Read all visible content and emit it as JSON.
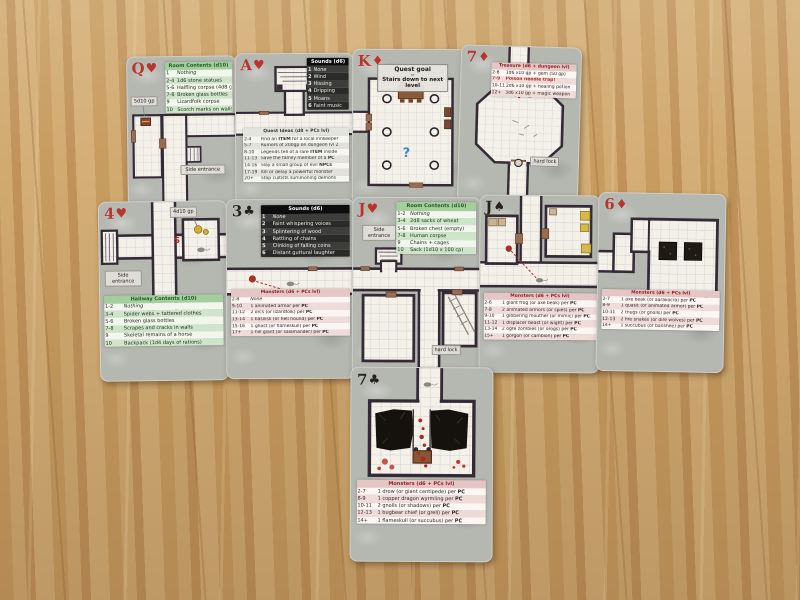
{
  "cards": [
    {
      "rank": "Q",
      "suit": "♥",
      "color": "red",
      "labels": {
        "gold": "5d10 gp",
        "entrance": "Side entrance"
      },
      "tables": {
        "room": {
          "title": "Room Contents",
          "die": "(d10)",
          "rows": [
            [
              "1",
              "Nothing"
            ],
            [
              "2-4",
              "1d6 stone statues"
            ],
            [
              "5-6",
              "Halfling corpse (4d8 gp)"
            ],
            [
              "7-8",
              "Broken glass bottles"
            ],
            [
              "9",
              "Lizardfolk corpse"
            ],
            [
              "10",
              "Scorch marks on walls"
            ]
          ]
        }
      }
    },
    {
      "rank": "A",
      "suit": "♥",
      "color": "red",
      "tables": {
        "sounds": {
          "title": "Sounds",
          "die": "(d6)",
          "rows": [
            [
              "1",
              "None"
            ],
            [
              "2",
              "Wind"
            ],
            [
              "3",
              "Hissing"
            ],
            [
              "4",
              "Dripping"
            ],
            [
              "5",
              "Moans"
            ],
            [
              "6",
              "Faint music"
            ]
          ]
        },
        "quests": {
          "title": "Quest Ideas",
          "die": "(d8 + PCs lvl)",
          "rows": [
            [
              "2-4",
              "Find an ITEM for a local innkeeper"
            ],
            [
              "5-7",
              "Rumors of 200gp on dungeon lvl 2"
            ],
            [
              "8-10",
              "Legends tell of a rare ITEM inside"
            ],
            [
              "11-13",
              "Save the family member of a PC"
            ],
            [
              "14-16",
              "Slay a small group of evil NPCs"
            ],
            [
              "17-19",
              "Kill or delay a powerful monster"
            ],
            [
              "20+",
              "Stop cultists summoning demons"
            ]
          ]
        }
      }
    },
    {
      "rank": "K",
      "suit": "♦",
      "color": "red",
      "goal": {
        "line1": "Quest goal",
        "line2": "or",
        "line3": "Stairs down to next level"
      },
      "labels": {
        "mystery": "?"
      }
    },
    {
      "rank": "7",
      "suit": "♦",
      "color": "red",
      "labels": {
        "lock": "hard lock"
      },
      "tables": {
        "treasure": {
          "title": "Treasure",
          "die": "(d6 + dungeon lvl)",
          "rows": [
            [
              "2-6",
              "1d6 x10 gp + gem (50 gp)"
            ],
            [
              "7-9",
              "Poison needle trap!",
              "alert"
            ],
            [
              "10-11",
              "2d6 x10 gp + healing potion"
            ],
            [
              "12+",
              "3d6 x10 gp + magic weapon"
            ]
          ]
        }
      }
    },
    {
      "rank": "4",
      "suit": "♥",
      "color": "red",
      "labels": {
        "gold": "4d10 gp",
        "entrance": "Side entrance",
        "secret": "S"
      },
      "tables": {
        "hallway": {
          "title": "Hallway Contents",
          "die": "(d10)",
          "rows": [
            [
              "1-2",
              "Nothing"
            ],
            [
              "3-4",
              "Spider webs + tattered clothes"
            ],
            [
              "5-6",
              "Broken glass bottles"
            ],
            [
              "7-8",
              "Scrapes and cracks in walls"
            ],
            [
              "9",
              "Skeletal remains of a horse"
            ],
            [
              "10",
              "Backpack (1d4 days of rations)"
            ]
          ]
        }
      }
    },
    {
      "rank": "3",
      "suit": "♣",
      "color": "black",
      "tables": {
        "sounds": {
          "title": "Sounds",
          "die": "(d6)",
          "rows": [
            [
              "1",
              "None"
            ],
            [
              "2",
              "Faint whispering voices"
            ],
            [
              "3",
              "Splintering of wood"
            ],
            [
              "4",
              "Rattling of chains"
            ],
            [
              "5",
              "Clinking of falling coins"
            ],
            [
              "6",
              "Distant guttural laughter"
            ]
          ]
        },
        "monsters": {
          "title": "Monsters",
          "die": "(d6 + PCs lvl)",
          "rows": [
            [
              "2-8",
              "None"
            ],
            [
              "9-10",
              "1 animated armor per PC"
            ],
            [
              "11-12",
              "2 orcs (or lizardfolk) per PC"
            ],
            [
              "13-14",
              "1 basilisk (or hell hound) per PC"
            ],
            [
              "15-16",
              "1 ghost (or flameskull) per PC"
            ],
            [
              "17+",
              "1 hill giant (or salamander) per PC"
            ]
          ]
        }
      }
    },
    {
      "rank": "J",
      "suit": "♥",
      "color": "red",
      "labels": {
        "entrance": "Side entrance",
        "lock": "hard lock"
      },
      "tables": {
        "room": {
          "title": "Room Contents",
          "die": "(d10)",
          "rows": [
            [
              "1-2",
              "Nothing"
            ],
            [
              "3-4",
              "2d8 sacks of wheat"
            ],
            [
              "5-6",
              "Broken chest (empty)"
            ],
            [
              "7-8",
              "Human corpse"
            ],
            [
              "9",
              "Chains + cages"
            ],
            [
              "10",
              "Sack (1d10 x 100 cp)"
            ]
          ]
        }
      }
    },
    {
      "rank": "J",
      "suit": "♠",
      "color": "black",
      "tables": {
        "monsters": {
          "title": "Monsters",
          "die": "(d6 + PCs lvl)",
          "rows": [
            [
              "2-6",
              "1 giant frog (or axe beak) per PC"
            ],
            [
              "7-8",
              "2 animated armors (or spies) per PC"
            ],
            [
              "9-10",
              "1 gibbering mouther (or mimic) per PC"
            ],
            [
              "11-12",
              "1 displacer beast (or wight) per PC"
            ],
            [
              "13-14",
              "2 ogre zombies (or orogs) per PC"
            ],
            [
              "15+",
              "1 gorgon (or cambion) per PC"
            ]
          ]
        }
      }
    },
    {
      "rank": "6",
      "suit": "♦",
      "color": "red",
      "tables": {
        "monsters": {
          "title": "Monsters",
          "die": "(d6 + PCs lvl)",
          "rows": [
            [
              "2-7",
              "1 axe beak (or aarakocra) per PC"
            ],
            [
              "8-9",
              "1 quasit (or animated armor) per PC"
            ],
            [
              "10-11",
              "2 thugs (or gnolls) per PC"
            ],
            [
              "12-13",
              "2 fire snakes (or dire wolves) per PC"
            ],
            [
              "14+",
              "1 succubus (or banshee) per PC"
            ]
          ]
        }
      }
    },
    {
      "rank": "7",
      "suit": "♣",
      "color": "black",
      "tables": {
        "monsters": {
          "title": "Monsters",
          "die": "(d6 + PCs lvl)",
          "rows": [
            [
              "2-7",
              "1 drow (or giant centipede) per PC"
            ],
            [
              "8-9",
              "1 copper dragon wyrmling per PC"
            ],
            [
              "10-11",
              "2 gnolls (or shadows) per PC"
            ],
            [
              "12-13",
              "1 bugbear chief (or grell) per PC"
            ],
            [
              "14+",
              "1 flameskull (or succubus) per PC"
            ]
          ]
        }
      }
    }
  ]
}
